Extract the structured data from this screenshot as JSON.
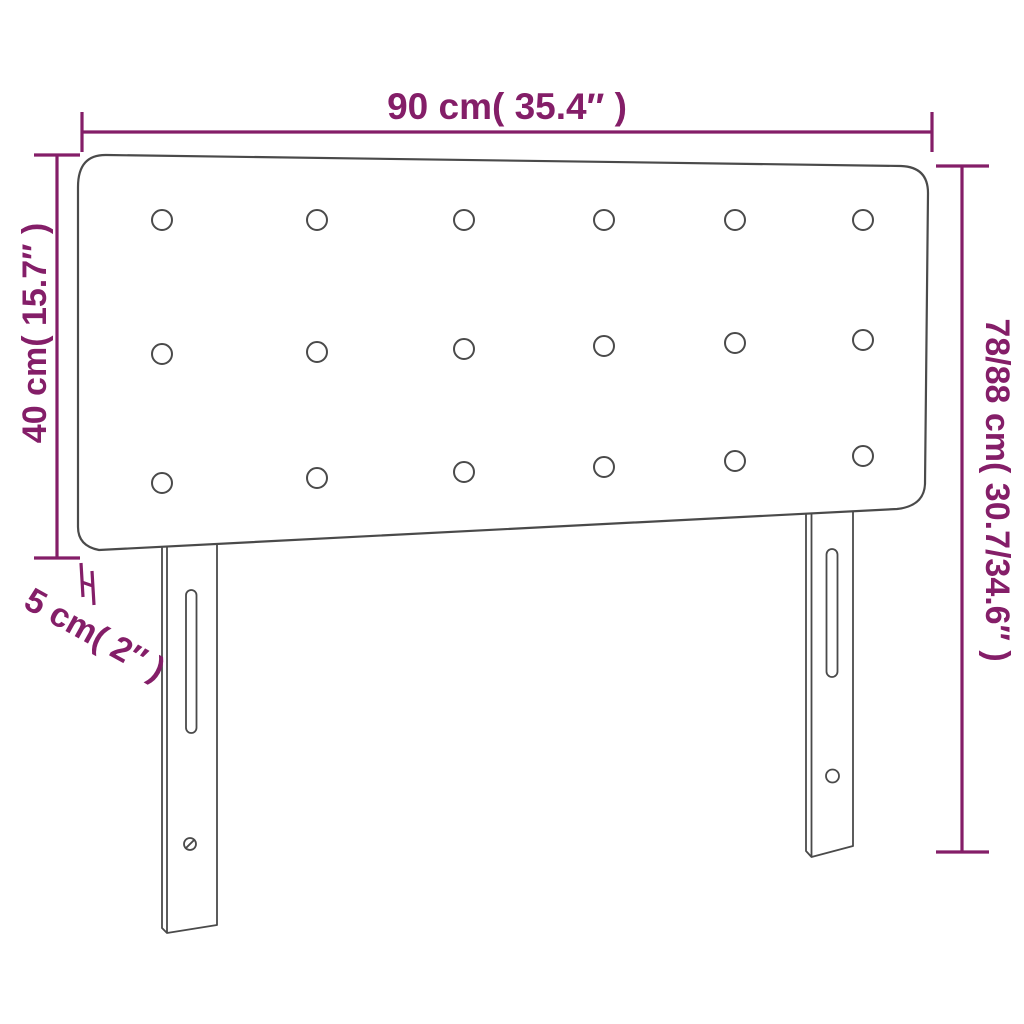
{
  "diagram": {
    "type": "product-dimension-diagram",
    "product": "upholstered headboard with legs",
    "labels": {
      "width": "90 cm( 35.4″ )",
      "panel_height": "40 cm( 15.7″ )",
      "thickness": "5 cm( 2″ )",
      "total_height": "78/88 cm( 30.7/34.6″ )"
    },
    "colors": {
      "dimension": "#841e68",
      "outline": "#4a4a4a",
      "background": "#ffffff"
    },
    "buttons": {
      "count": 18,
      "columns_x": [
        162,
        317,
        464,
        604,
        735,
        863
      ],
      "rows_y": [
        [
          220,
          220,
          220,
          220,
          220,
          220
        ],
        [
          354,
          352,
          349,
          346,
          343,
          340
        ],
        [
          483,
          478,
          472,
          467,
          461,
          456
        ]
      ],
      "radius": 10
    }
  }
}
